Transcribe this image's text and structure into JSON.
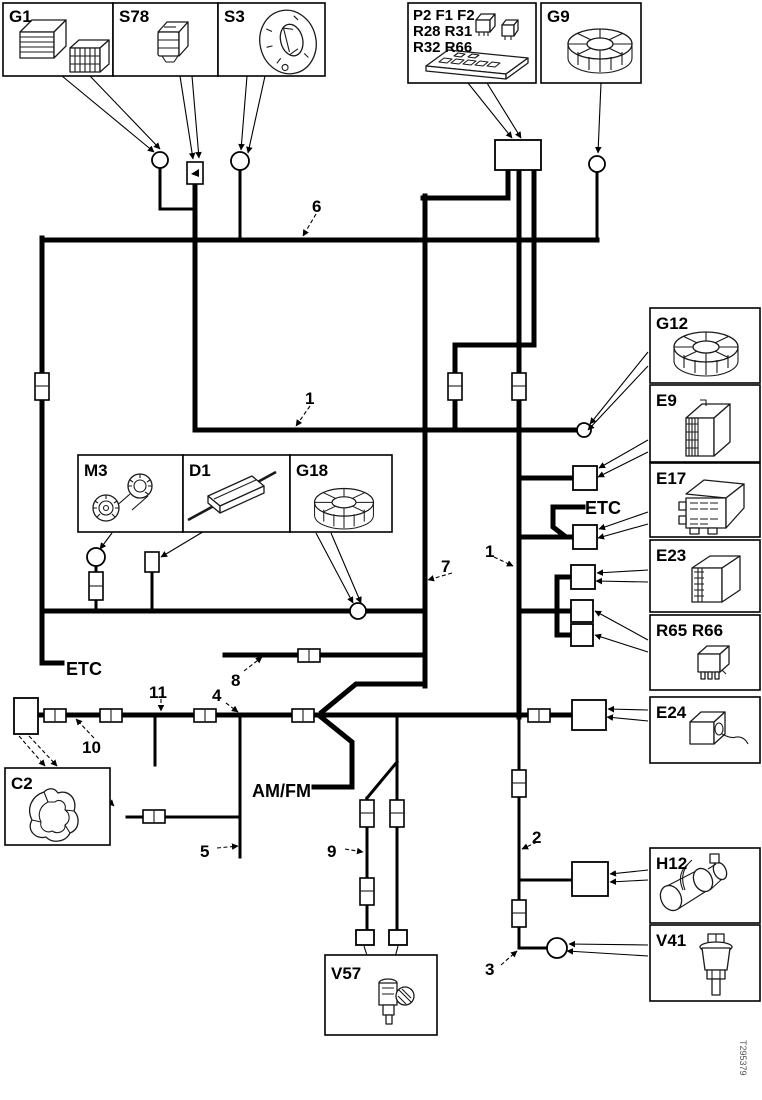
{
  "diagram_type": "vehicle wiring harness schematic",
  "components": {
    "g1": "G1",
    "s78": "S78",
    "s3": "S3",
    "p2_group_line1": "P2 F1 F2",
    "p2_group_line2": "R28 R31",
    "p2_group_line3": "R32 R66",
    "g9": "G9",
    "g12": "G12",
    "e9": "E9",
    "e17": "E17",
    "e23": "E23",
    "r65_r66": "R65 R66",
    "e24": "E24",
    "h12": "H12",
    "v41": "V41",
    "m3": "M3",
    "d1": "D1",
    "g18": "G18",
    "c2": "C2",
    "v57": "V57"
  },
  "wires": {
    "w1": "1",
    "w2": "2",
    "w3": "3",
    "w4": "4",
    "w5": "5",
    "w6": "6",
    "w7": "7",
    "w8": "8",
    "w9": "9",
    "w10": "10",
    "w11": "11"
  },
  "labels": {
    "etc_left": "ETC",
    "etc_right": "ETC",
    "am_fm": "AM/FM"
  },
  "figure_number": "T295379",
  "colors": {
    "wire": "#000000",
    "background": "#ffffff",
    "box_border": "#000000",
    "figure_number_text": "#555555"
  }
}
